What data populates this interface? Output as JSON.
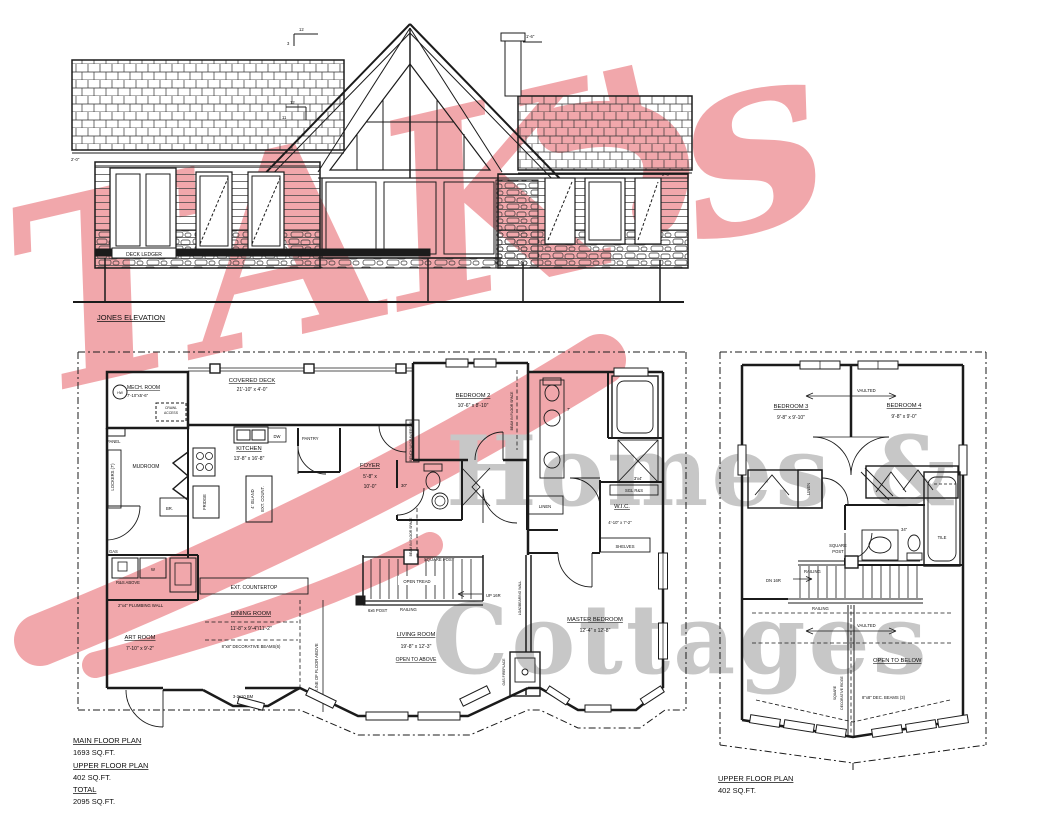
{
  "wm": {
    "script": "TAK's",
    "h1": "Homes &",
    "h2": "Cottages",
    "pink": "#f1a7ab",
    "gray": "#c7c7c7"
  },
  "elev": {
    "caption": "JONES ELEVATION",
    "ledger": "DECK LEDGER",
    "p12": "12",
    "p3": "3",
    "p11": "11",
    "dim2l": "2'-0\"",
    "dim2r": "2'-0\"",
    "dim16": "1'-6\""
  },
  "mf": {
    "mech_name": "MECH. ROOM",
    "mech_dims": "7'-10\"x5'-6\"",
    "hw": "HW",
    "crawl1": "CRAWL",
    "crawl2": "ACCESS",
    "panel": "PANEL",
    "deck_name": "COVERED DECK",
    "deck_dims": "21'-10\" x 4'-0\"",
    "kitchen_name": "KITCHEN",
    "kitchen_dims": "13'-8\" x 16'-8\"",
    "dw": "DW",
    "pantry": "PANTRY",
    "mudroom": "MUDROOM",
    "lockers": "LOCKERS (7')",
    "br": "BR.",
    "fridge": "FRIDGE",
    "island": "4' ISLAND",
    "ext_count": "EXT. COUNT.",
    "gas": "GAS",
    "w": "W",
    "rs_above": "R&S ABOVE",
    "plumb": "2\"x4\" PLUMBING WALL",
    "ext_ctop": "EXT. COUNTERTOP",
    "dining_name": "DINING ROOM",
    "dining_dims": "11'-8\" x 9'-4\"/11'-2\"",
    "beams": "8\"x8\" DECORATIVE BEAMS(6)",
    "art_name": "ART ROOM",
    "art_dims": "7'-10\" x 9'-2\"",
    "bm": "3-2x10 BM",
    "line_above": "LINE OF FLOOR ABOVE",
    "foyer_name": "FOYER",
    "foyer_d1": "5'-8\" x",
    "foyer_d2": "10'-0\"",
    "bench": "BENCH W/ DRAWERS (4')",
    "bed2_name": "BEDROOM 2",
    "bed2_dims": "10'-6\" x 8'-10\"",
    "beam_space": "BEAM IN FLOOR SPACE",
    "d30": "30\"",
    "linen": "LINEN",
    "wic_name": "W.I.C.",
    "wic_dims": "4'-10\" x 7'-2\"",
    "sgl": "SGL R&S",
    "shelves": "SHELVES",
    "master_name": "MASTER BEDROOM",
    "master_dims": "12'-4\" x 12'-8\"",
    "gasfp": "GAS FIREPLACE",
    "lbw": "LOADBEARING WALL",
    "sq_post": "SQUARE POST",
    "open_tread": "OPEN TREAD",
    "up": "UP 16R",
    "railing": "RAILING",
    "post66": "6x6 POST",
    "living_name": "LIVING ROOM",
    "living_dims": "19'-8\" x 12'-3\"",
    "open_above": "OPEN TO ABOVE",
    "shower": "3'x4'",
    "seven": "7'"
  },
  "uf": {
    "vaulted": "VAULTED",
    "b3_name": "BEDROOM 3",
    "b3_dims": "9'-8\" x 9'-10\"",
    "b4_name": "BEDROOM 4",
    "b4_dims": "9'-8\" x 9'-0\"",
    "linen": "LINEN",
    "tile": "TILE",
    "s34": "34\"",
    "sq1": "SQUARE",
    "sq2": "POST",
    "railing": "RAILING",
    "dn": "DN 16R",
    "open_below": "OPEN TO BELOW",
    "beams": "8\"x8\" DEC. BEAMS (3)",
    "ridge1": "SQUARE",
    "ridge2": "DECORATIVE RIDGE"
  },
  "sum": {
    "l1": "MAIN FLOOR PLAN",
    "v1": "1693 SQ.FT.",
    "l2": "UPPER FLOOR PLAN",
    "v2": "402 SQ.FT.",
    "l3": "TOTAL",
    "v3": "2095 SQ.FT.",
    "uc1": "UPPER FLOOR PLAN",
    "uc2": "402 SQ.FT."
  }
}
